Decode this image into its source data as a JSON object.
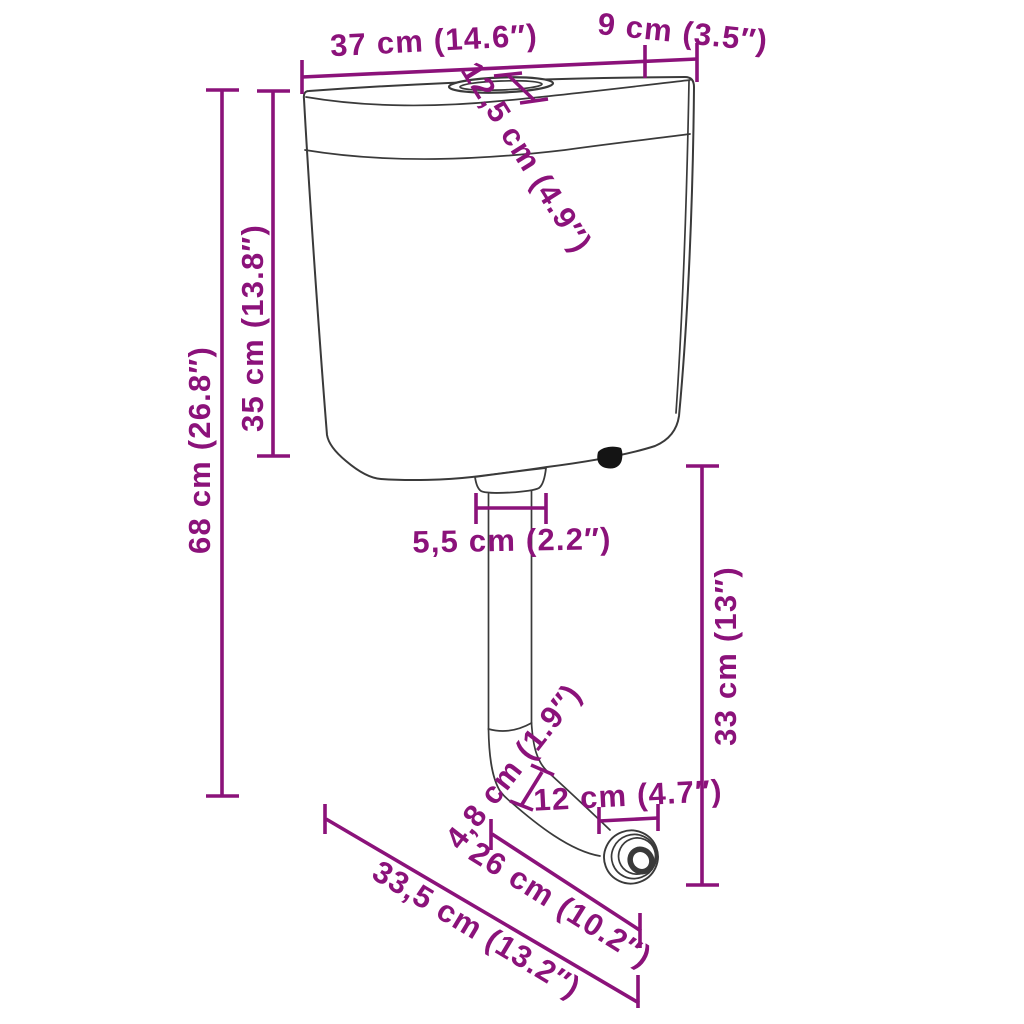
{
  "diagram": {
    "title": "Toilet flush cistern dimension diagram",
    "subject": "wall-mounted flush cistern with flush pipe, elbow and outlet connector",
    "style": {
      "dimension_color": "#8B127A",
      "outline_color": "#3a3a3a",
      "background": "#ffffff"
    },
    "labels": {
      "tank_width": "37 cm (14.6″)",
      "tank_depth": "9 cm (3.5″)",
      "lid_depth": "12,5 cm (4.9″)",
      "tank_height": "35 cm (13.8″)",
      "total_height": "68 cm (26.8″)",
      "outlet_width": "5,5 cm (2.2″)",
      "pipe_height": "33 cm (13″)",
      "pipe_diameter": "4,8 cm (1.9″)",
      "connector_width": "12 cm (4.7″)",
      "pipe_run_length": "26 cm (10.2″)",
      "base_width": "33,5 cm (13.2″)"
    }
  }
}
